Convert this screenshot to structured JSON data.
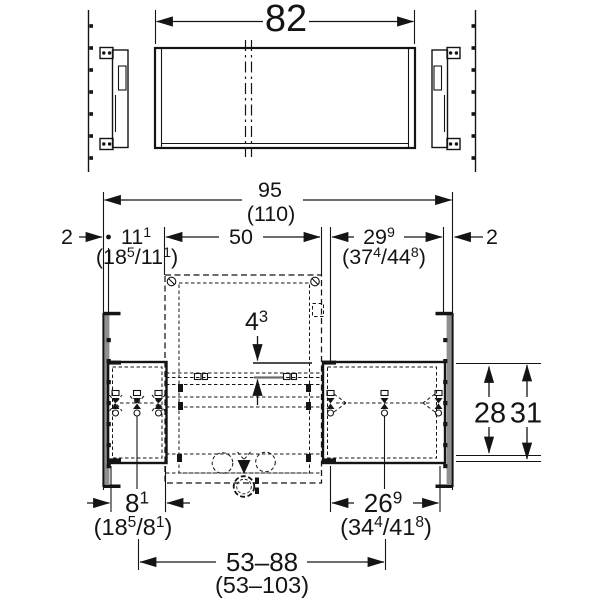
{
  "colors": {
    "ink": "#141414",
    "rail_gray": "#8f8f8f",
    "background": "#ffffff"
  },
  "top_view": {
    "panel_width": [
      {
        "t": "82"
      }
    ]
  },
  "front_view": {
    "overall_width": [
      {
        "t": "95"
      }
    ],
    "overall_width_alt": [
      {
        "t": "(110)"
      }
    ],
    "wall_rail_thickness_left": [
      {
        "t": "2"
      }
    ],
    "offset_left": [
      {
        "t": "11"
      },
      {
        "t": "1",
        "sup": true
      }
    ],
    "offset_left_alt": [
      {
        "t": "(18"
      },
      {
        "t": "5",
        "sup": true
      },
      {
        "t": "/11"
      },
      {
        "t": "1",
        "sup": true
      },
      {
        "t": ")"
      }
    ],
    "frame_width": [
      {
        "t": "50"
      }
    ],
    "offset_right": [
      {
        "t": "29"
      },
      {
        "t": "9",
        "sup": true
      }
    ],
    "offset_right_alt": [
      {
        "t": "(37"
      },
      {
        "t": "4",
        "sup": true
      },
      {
        "t": "/44"
      },
      {
        "t": "8",
        "sup": true
      },
      {
        "t": ")"
      }
    ],
    "wall_rail_thickness_right": [
      {
        "t": "2"
      }
    ],
    "crossbar_gap": [
      {
        "t": "4"
      },
      {
        "t": "3",
        "sup": true
      }
    ],
    "box_height_inner": [
      {
        "t": "28"
      }
    ],
    "box_height_outer": [
      {
        "t": "31"
      }
    ],
    "supply_offset": [
      {
        "t": "8"
      },
      {
        "t": "1",
        "sup": true
      }
    ],
    "supply_offset_alt": [
      {
        "t": "(18"
      },
      {
        "t": "5",
        "sup": true
      },
      {
        "t": "/8"
      },
      {
        "t": "1",
        "sup": true
      },
      {
        "t": ")"
      }
    ],
    "drain_offset": [
      {
        "t": "26"
      },
      {
        "t": "9",
        "sup": true
      }
    ],
    "drain_offset_alt": [
      {
        "t": "(34"
      },
      {
        "t": "4",
        "sup": true
      },
      {
        "t": "/41"
      },
      {
        "t": "8",
        "sup": true
      },
      {
        "t": ")"
      }
    ],
    "adjust_range": [
      {
        "t": "53–88"
      }
    ],
    "adjust_range_alt": [
      {
        "t": "(53–103)"
      }
    ]
  }
}
